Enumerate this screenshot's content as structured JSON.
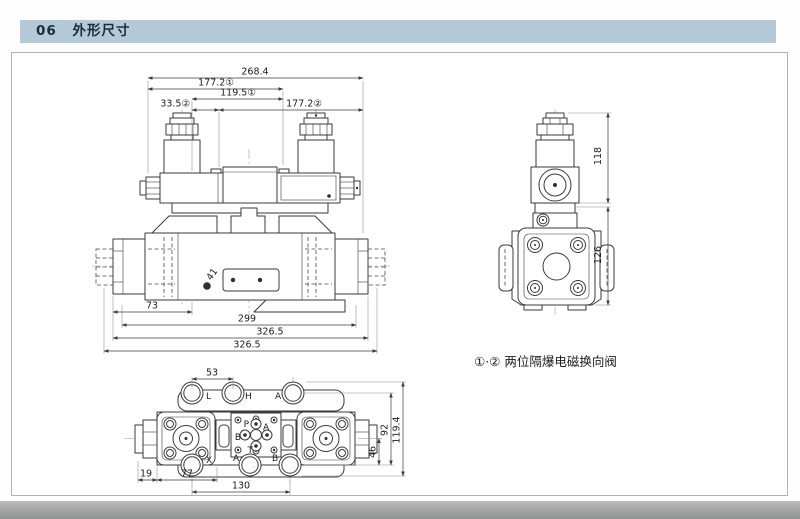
{
  "header": {
    "section_number": "06",
    "section_title": "外形尺寸"
  },
  "note": "①·② 两位隔爆电磁换向阀",
  "front_view": {
    "dim_total_length": "268.4",
    "dim_sol1_length": "177.2①",
    "dim_pilot_length": "119.5①",
    "dim_sol2_offset": "33.5②",
    "dim_sol2_length": "177.2②",
    "dim_73": "73",
    "dim_299": "299",
    "dim_326_5_inner": "326.5",
    "dim_326_5_outer": "326.5",
    "dim_41": "41"
  },
  "side_view": {
    "dim_118": "118",
    "dim_126": "126"
  },
  "bottom_view": {
    "dim_53": "53",
    "dim_19": "19",
    "dim_77": "77",
    "dim_130": "130",
    "dim_46": "46",
    "dim_92": "92",
    "dim_119_4": "119.4",
    "ports_top": {
      "l": "L",
      "h": "H",
      "a": "A"
    },
    "ports_bottom": {
      "x": "X",
      "a": "A",
      "b": "B"
    },
    "ports_center": {
      "p": "P",
      "a": "A",
      "b": "B",
      "t": "T"
    }
  }
}
